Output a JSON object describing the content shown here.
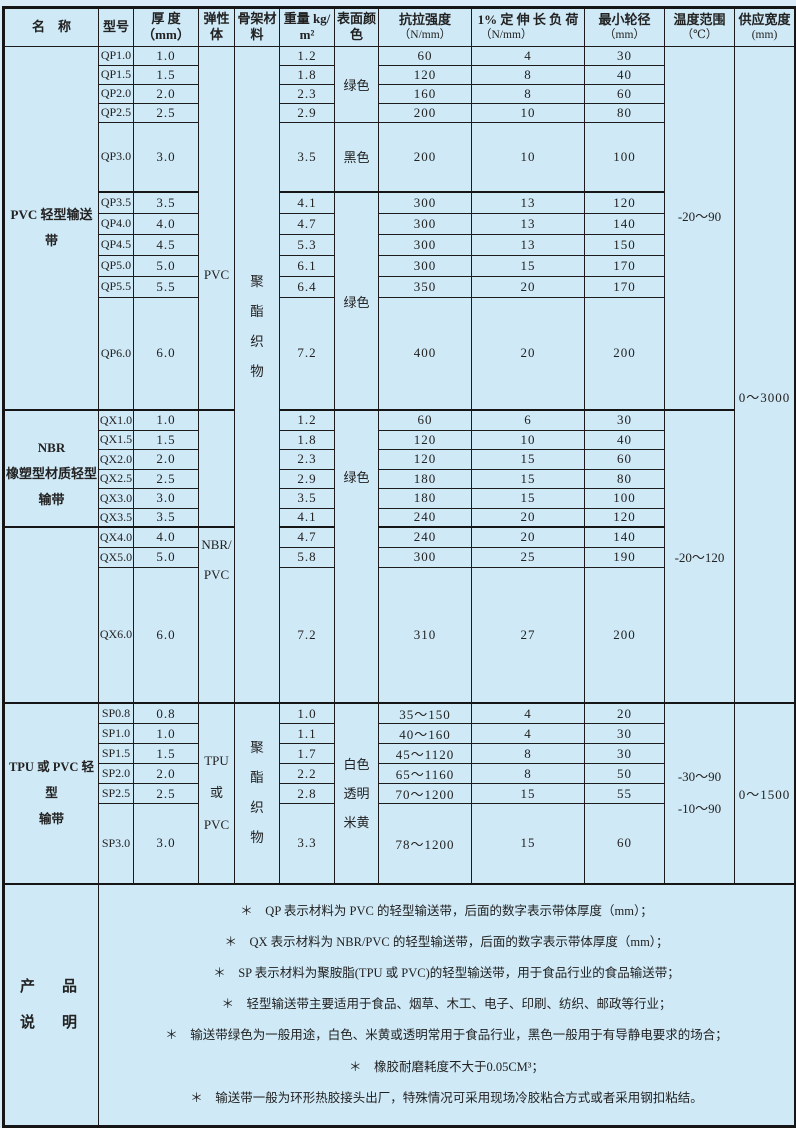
{
  "colors": {
    "background": "#cfe9f6",
    "border": "#1c1c1c",
    "text": "#222222"
  },
  "table": {
    "headers": [
      {
        "t": "名　称",
        "u": ""
      },
      {
        "t": "型号",
        "u": ""
      },
      {
        "t": "厚 度（mm）",
        "u": ""
      },
      {
        "t": "弹性\n体",
        "u": ""
      },
      {
        "t": "骨架材\n料",
        "u": ""
      },
      {
        "t": "重量 kg/\nm²",
        "u": ""
      },
      {
        "t": "表面颜\n色",
        "u": ""
      },
      {
        "t": "抗拉强度",
        "u": "（N/mm）"
      },
      {
        "t": "1% 定 伸 长 负 荷",
        "u": "（N/mm）"
      },
      {
        "t": "最小轮径",
        "u": "（mm）"
      },
      {
        "t": "温度范围",
        "u": "（℃）"
      },
      {
        "t": "供应宽度",
        "u": "(mm)"
      }
    ],
    "s1": {
      "name": "PVC 轻型输送带",
      "elastomer": "PVC",
      "skeleton": "聚\n酯\n织\n物",
      "color_top": "绿色",
      "color_mid": "黑色",
      "color_bottom": "绿色",
      "temp": "-20～90",
      "supply": "0～3000",
      "rows": [
        [
          "QP1.0",
          "1.0",
          "1.2",
          "60",
          "4",
          "30"
        ],
        [
          "QP1.5",
          "1.5",
          "1.8",
          "120",
          "8",
          "40"
        ],
        [
          "QP2.0",
          "2.0",
          "2.3",
          "160",
          "8",
          "60"
        ],
        [
          "QP2.5",
          "2.5",
          "2.9",
          "200",
          "10",
          "80"
        ],
        [
          "QP3.0",
          "3.0",
          "3.5",
          "200",
          "10",
          "100"
        ],
        [
          "QP3.5",
          "3.5",
          "4.1",
          "300",
          "13",
          "120"
        ],
        [
          "QP4.0",
          "4.0",
          "4.7",
          "300",
          "13",
          "140"
        ],
        [
          "QP4.5",
          "4.5",
          "5.3",
          "300",
          "13",
          "150"
        ],
        [
          "QP5.0",
          "5.0",
          "6.1",
          "300",
          "15",
          "170"
        ],
        [
          "QP5.5",
          "5.5",
          "6.4",
          "350",
          "20",
          "170"
        ],
        [
          "QP6.0",
          "6.0",
          "7.2",
          "400",
          "20",
          "200"
        ]
      ]
    },
    "s2": {
      "name": "NBR\n橡塑型材质轻型\n输带",
      "elastomer": "",
      "color": "绿色",
      "temp": "-20～120",
      "rows": [
        [
          "QX1.0",
          "1.0",
          "1.2",
          "60",
          "6",
          "30"
        ],
        [
          "QX1.5",
          "1.5",
          "1.8",
          "120",
          "10",
          "40"
        ],
        [
          "QX2.0",
          "2.0",
          "2.3",
          "120",
          "15",
          "60"
        ],
        [
          "QX2.5",
          "2.5",
          "2.9",
          "180",
          "15",
          "80"
        ],
        [
          "QX3.0",
          "3.0",
          "3.5",
          "180",
          "15",
          "100"
        ],
        [
          "QX3.5",
          "3.5",
          "4.1",
          "240",
          "20",
          "120"
        ]
      ]
    },
    "s3": {
      "name": "",
      "elastomer": "NBR/\nPVC",
      "rows": [
        [
          "QX4.0",
          "4.0",
          "4.7",
          "240",
          "20",
          "140"
        ],
        [
          "QX5.0",
          "5.0",
          "5.8",
          "300",
          "25",
          "190"
        ],
        [
          "QX6.0",
          "6.0",
          "7.2",
          "310",
          "27",
          "200"
        ]
      ]
    },
    "s4": {
      "name": "TPU 或 PVC 轻型\n输带",
      "elastomer": "TPU 或\nPVC",
      "skeleton": "聚\n酯\n织\n物",
      "color": "白色\n透明\n米黄",
      "temp": "-30～90\n-10～90",
      "supply": "0～1500",
      "rows": [
        [
          "SP0.8",
          "0.8",
          "1.0",
          "35～150",
          "4",
          "20"
        ],
        [
          "SP1.0",
          "1.0",
          "1.1",
          "40～160",
          "4",
          "30"
        ],
        [
          "SP1.5",
          "1.5",
          "1.7",
          "45～1120",
          "8",
          "30"
        ],
        [
          "SP2.0",
          "2.0",
          "2.2",
          "65～1160",
          "8",
          "50"
        ],
        [
          "SP2.5",
          "2.5",
          "2.8",
          "70～1200",
          "15",
          "55"
        ],
        [
          "SP3.0",
          "3.0",
          "3.3",
          "78～1200",
          "15",
          "60"
        ]
      ]
    }
  },
  "notes": {
    "title": "产　品\n说　明",
    "lines": [
      "＊　QP 表示材料为 PVC 的轻型输送带，后面的数字表示带体厚度（mm）；",
      "＊　QX 表示材料为 NBR/PVC 的轻型输送带，后面的数字表示带体厚度（mm）；",
      "＊　SP 表示材料为聚胺脂(TPU 或 PVC)的轻型输送带，用于食品行业的食品输送带；",
      "＊　轻型输送带主要适用于食品、烟草、木工、电子、印刷、纺织、邮政等行业；",
      "＊　输送带绿色为一般用途，白色、米黄或透明常用于食品行业，黑色一般用于有导静电要求的场合；",
      "＊　橡胶耐磨耗度不大于0.05CM³；",
      "＊　输送带一般为环形热胶接头出厂，特殊情况可采用现场冷胶粘合方式或者采用钢扣粘结。"
    ]
  }
}
